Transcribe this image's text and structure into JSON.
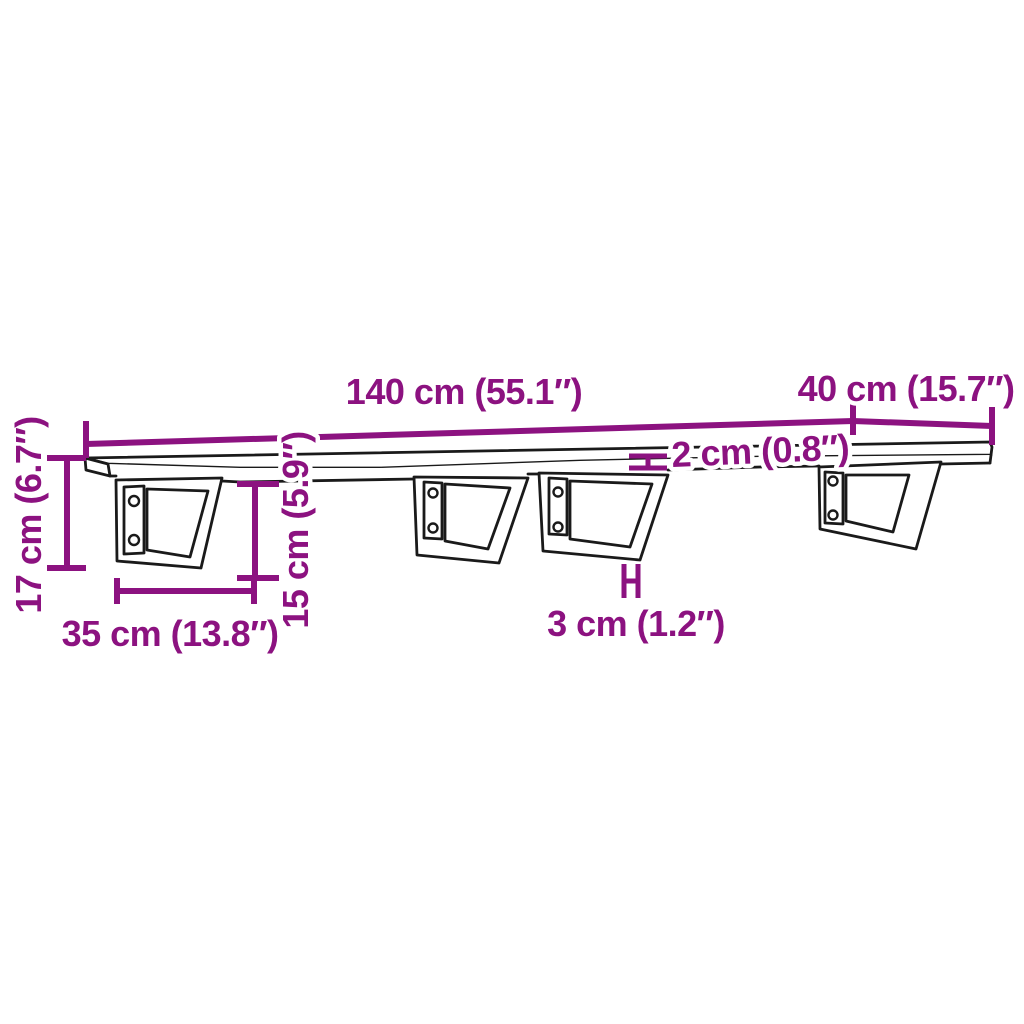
{
  "diagram": {
    "type": "product-dimension-drawing",
    "subject": "wall-mounted shelf board on four steel brackets",
    "bracket_count": 4,
    "colors": {
      "dimension_accent": "#8C1280",
      "outline": "#1a1a1a",
      "background": "#ffffff"
    },
    "dimensions": {
      "length": {
        "label": "140 cm (55.1″)",
        "cm": "140",
        "inches": "55.1"
      },
      "depth": {
        "label": "40 cm (15.7″)",
        "cm": "40",
        "inches": "15.7"
      },
      "total_height": {
        "label": "17 cm (6.7″)",
        "cm": "17",
        "inches": "6.7"
      },
      "bracket_height": {
        "label": "15 cm (5.9″)",
        "cm": "15",
        "inches": "5.9"
      },
      "board_thickness": {
        "label": "2 cm (0.8″)",
        "cm": "2",
        "inches": "0.8"
      },
      "bracket_depth": {
        "label": "35 cm (13.8″)",
        "cm": "35",
        "inches": "13.8"
      },
      "bracket_leg_width": {
        "label": "3 cm (1.2″)",
        "cm": "3",
        "inches": "1.2"
      }
    }
  }
}
